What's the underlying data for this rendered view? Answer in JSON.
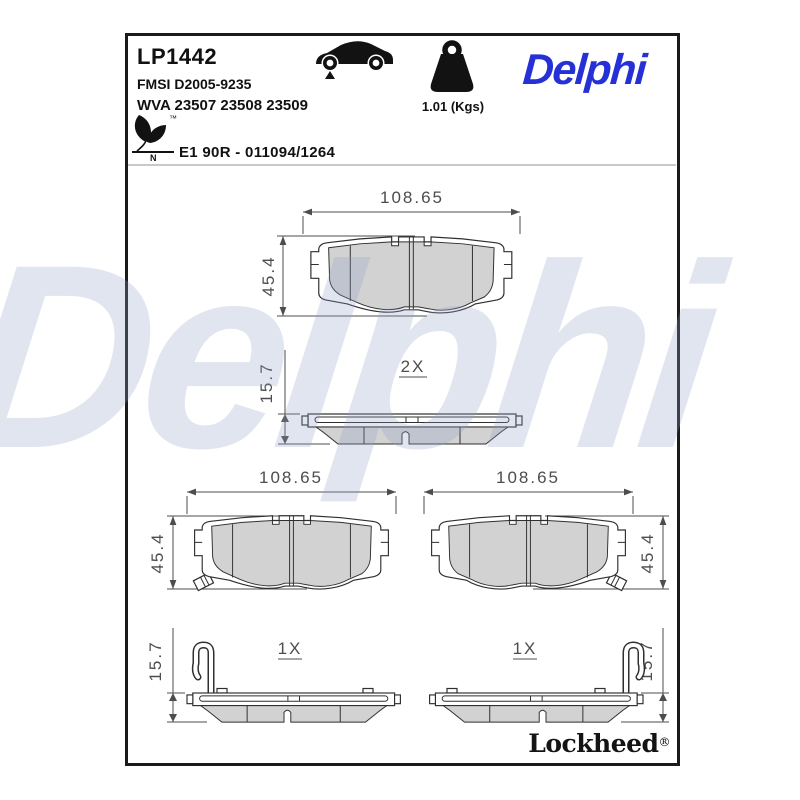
{
  "header": {
    "part_number": "LP1442",
    "fmsi": "FMSI D2005-9235",
    "wva": "WVA 23507 23508 23509",
    "homologation": "E1 90R - 011094/1264",
    "weight": "1.01 (Kgs)",
    "leaf_mark_letter": "N",
    "leaf_trademark": "™",
    "brand": "Delphi"
  },
  "footer": {
    "brand": "Lockheed",
    "registered": "®"
  },
  "watermark": {
    "text": "Delphi"
  },
  "icons": [
    "car-front-axle-icon",
    "weight-icon",
    "eco-leaf-icon"
  ],
  "colors": {
    "accent_blue": "#2531d6",
    "friction_gray": "#d2d2d2",
    "line_dark": "#2f2f2f",
    "dim_gray": "#4d4d4d",
    "border_black": "#1b1b1b"
  },
  "dims": {
    "front_pair_width": "108.65",
    "front_pair_height": "45.4",
    "pair_qty": "2X",
    "pair_thickness": "15.7",
    "left_width": "108.65",
    "left_height": "45.4",
    "right_width": "108.65",
    "right_height": "45.4",
    "left_qty": "1X",
    "left_thickness": "15.7",
    "right_qty": "1X",
    "right_thickness": "15.7"
  }
}
